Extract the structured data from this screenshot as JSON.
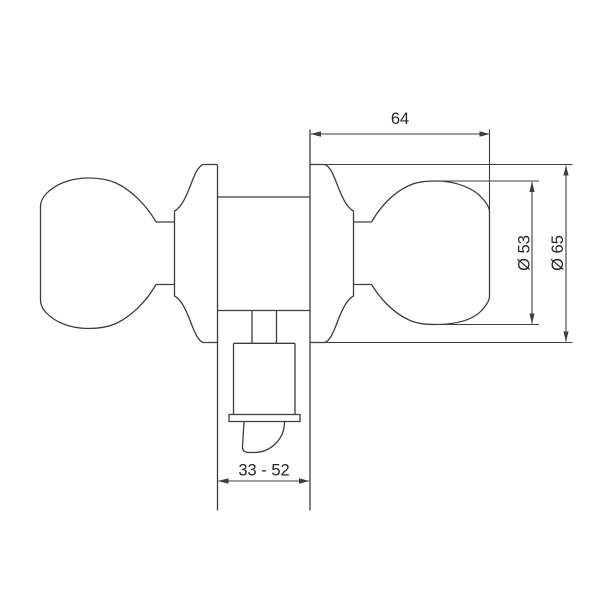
{
  "drawing": {
    "background_color": "#ffffff",
    "line_color": "#3e3e3e",
    "text_color": "#262626",
    "labels": {
      "overall_width": "64",
      "knob_diameter": "Ø 53",
      "rose_diameter": "Ø 65",
      "backset_range": "33 - 52"
    }
  }
}
